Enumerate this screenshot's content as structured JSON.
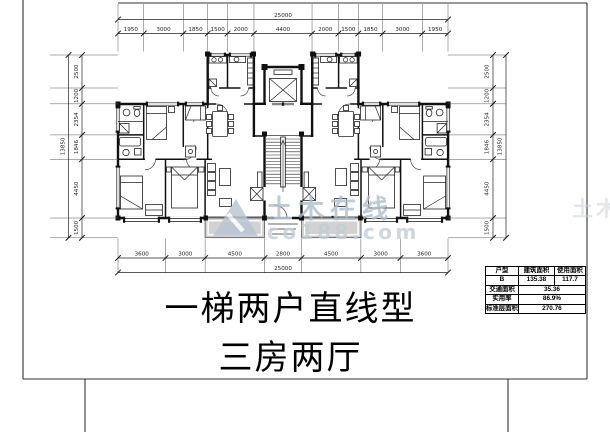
{
  "drawing": {
    "title_line1": "一梯两户直线型",
    "title_line2": "三房两厅"
  },
  "watermark": {
    "brand": "土木在线",
    "domain": "co188.com",
    "logo": "triangle-logo",
    "brand_color": "#aebdcc",
    "domain_color": "#c3cdd8"
  },
  "stats_table": {
    "headers": [
      "户型",
      "建筑面积",
      "使用面积"
    ],
    "unit_row": {
      "type": "B",
      "built_area": "135.38",
      "usable_area": "117.7"
    },
    "rows": [
      {
        "label": "交通面积",
        "value": "35.36"
      },
      {
        "label": "实用率",
        "value": "86.9%"
      },
      {
        "label": "标准层面积",
        "value": "270.76"
      }
    ]
  },
  "dimensions": {
    "top_total": "25000",
    "top_segments": [
      "1950",
      "3000",
      "1850",
      "1500",
      "2000",
      "4400",
      "2000",
      "1500",
      "1850",
      "3000",
      "1950"
    ],
    "bottom_total": "25000",
    "bottom_segments": [
      "3600",
      "3000",
      "4500",
      "2800",
      "4500",
      "3000",
      "3600"
    ],
    "left_total": "13850",
    "left_segments": [
      "2500",
      "1200",
      "2354",
      "1846",
      "4450",
      "1500"
    ],
    "right_total": "13850",
    "right_segments": [
      "2500",
      "1200",
      "2354",
      "1846",
      "4450",
      "1500"
    ]
  },
  "colors": {
    "wall": "#111111",
    "balcony_fill": "#d2d2d2"
  }
}
